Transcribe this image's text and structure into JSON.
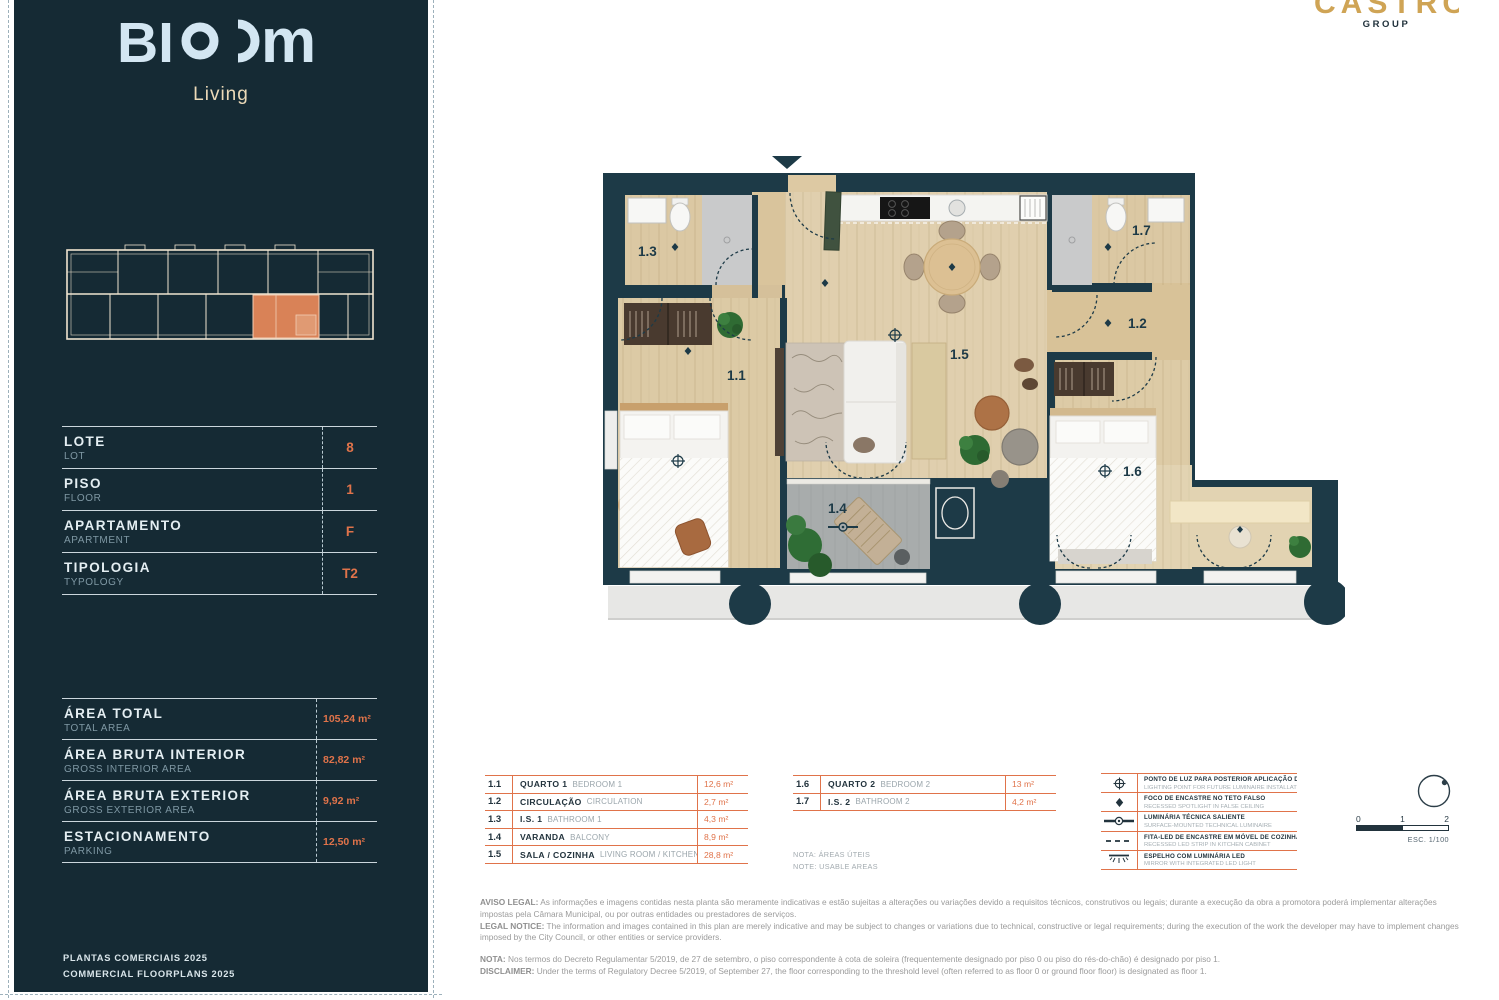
{
  "brand": {
    "wordmark_left": "BI",
    "wordmark_right": "m",
    "subtitle": "Living"
  },
  "partner": {
    "name": "CASTRO",
    "sub": "GROUP"
  },
  "unit_details": {
    "rows": [
      {
        "label_pt": "LOTE",
        "label_en": "LOT",
        "value": "8"
      },
      {
        "label_pt": "PISO",
        "label_en": "FLOOR",
        "value": "1"
      },
      {
        "label_pt": "APARTAMENTO",
        "label_en": "APARTMENT",
        "value": "F"
      },
      {
        "label_pt": "TIPOLOGIA",
        "label_en": "TYPOLOGY",
        "value": "T2"
      }
    ]
  },
  "areas": {
    "rows": [
      {
        "label_pt": "ÁREA TOTAL",
        "label_en": "TOTAL AREA",
        "value": "105,24 m²"
      },
      {
        "label_pt": "ÁREA BRUTA INTERIOR",
        "label_en": "GROSS INTERIOR AREA",
        "value": "82,82 m²"
      },
      {
        "label_pt": "ÁREA BRUTA EXTERIOR",
        "label_en": "GROSS EXTERIOR AREA",
        "value": "9,92 m²"
      },
      {
        "label_pt": "ESTACIONAMENTO",
        "label_en": "PARKING",
        "value": "12,50 m²"
      }
    ]
  },
  "footer": {
    "line1": "PLANTAS COMERCIAIS 2025",
    "line2": "COMMERCIAL FLOORPLANS 2025"
  },
  "plan": {
    "rooms": {
      "r1": "1.1",
      "r2": "1.2",
      "r3": "1.3",
      "r4": "1.4",
      "r5": "1.5",
      "r6": "1.6",
      "r7": "1.7"
    }
  },
  "legend_rooms_a": {
    "rows": [
      {
        "num": "1.1",
        "name_pt": "QUARTO 1",
        "name_en": "BEDROOM 1",
        "value": "12,6 m²"
      },
      {
        "num": "1.2",
        "name_pt": "CIRCULAÇÃO",
        "name_en": "CIRCULATION",
        "value": "2,7 m²"
      },
      {
        "num": "1.3",
        "name_pt": "I.S. 1",
        "name_en": "BATHROOM 1",
        "value": "4,3 m²"
      },
      {
        "num": "1.4",
        "name_pt": "VARANDA",
        "name_en": "BALCONY",
        "value": "8,9 m²"
      },
      {
        "num": "1.5",
        "name_pt": "SALA / COZINHA",
        "name_en": "LIVING ROOM / KITCHEN",
        "value": "28,8 m²"
      }
    ]
  },
  "legend_rooms_b": {
    "rows": [
      {
        "num": "1.6",
        "name_pt": "QUARTO 2",
        "name_en": "BEDROOM 2",
        "value": "13 m²"
      },
      {
        "num": "1.7",
        "name_pt": "I.S. 2",
        "name_en": "BATHROOM 2",
        "value": "4,2 m²"
      }
    ]
  },
  "notes": {
    "line1": "NOTA: ÁREAS ÚTEIS",
    "line2": "NOTE: USABLE AREAS"
  },
  "symbols": {
    "rows": [
      {
        "pt": "PONTO DE LUZ PARA POSTERIOR APLICAÇÃO DE LUMINÁRIA",
        "en": "LIGHTING POINT FOR FUTURE LUMINAIRE INSTALLATION"
      },
      {
        "pt": "FOCO DE ENCASTRE NO TETO FALSO",
        "en": "RECESSED SPOTLIGHT IN FALSE CEILING"
      },
      {
        "pt": "LUMINÁRIA TÉCNICA SALIENTE",
        "en": "SURFACE-MOUNTED TECHNICAL LUMINAIRE"
      },
      {
        "pt": "FITA-LED DE ENCASTRE EM MÓVEL DE COZINHA",
        "en": "RECESSED LED STRIP IN KITCHEN CABINET"
      },
      {
        "pt": "ESPELHO COM LUMINÁRIA LED",
        "en": "MIRROR WITH INTEGRATED LED LIGHT"
      }
    ]
  },
  "scale": {
    "t0": "0",
    "t1": "1",
    "t2": "2",
    "label": "ESC. 1/100"
  },
  "legal": {
    "aviso_label": "AVISO LEGAL:",
    "aviso_text": " As informações e imagens contidas nesta planta são meramente indicativas e estão sujeitas a alterações ou variações devido a requisitos técnicos, construtivos ou legais; durante a execução da obra a promotora poderá implementar alterações impostas pela Câmara Municipal, ou por outras entidades ou prestadores de serviços.",
    "notice_label": "LEGAL NOTICE:",
    "notice_text": " The information and images contained in this plan are merely indicative and may be subject to changes or variations due to technical, constructive or legal requirements; during the execution of the work the developer may have to implement changes imposed by the City Council, or other entities or service providers.",
    "nota_label": "NOTA:",
    "nota_text": " Nos termos do Decreto Regulamentar 5/2019, de 27 de setembro, o piso correspondente à cota de soleira (frequentemente designado por piso 0 ou piso do rés-do-chão) é designado por piso 1.",
    "disclaimer_label": "DISCLAIMER:",
    "disclaimer_text": " Under the terms of Regulatory Decree 5/2019, of September 27, the floor corresponding to the threshold level (often referred to as floor 0 or ground floor floor) is designated as floor 1."
  },
  "colors": {
    "accent": "#E0734A",
    "panel": "#152A34",
    "wall": "#1D3A47",
    "gold": "#CFA455"
  }
}
